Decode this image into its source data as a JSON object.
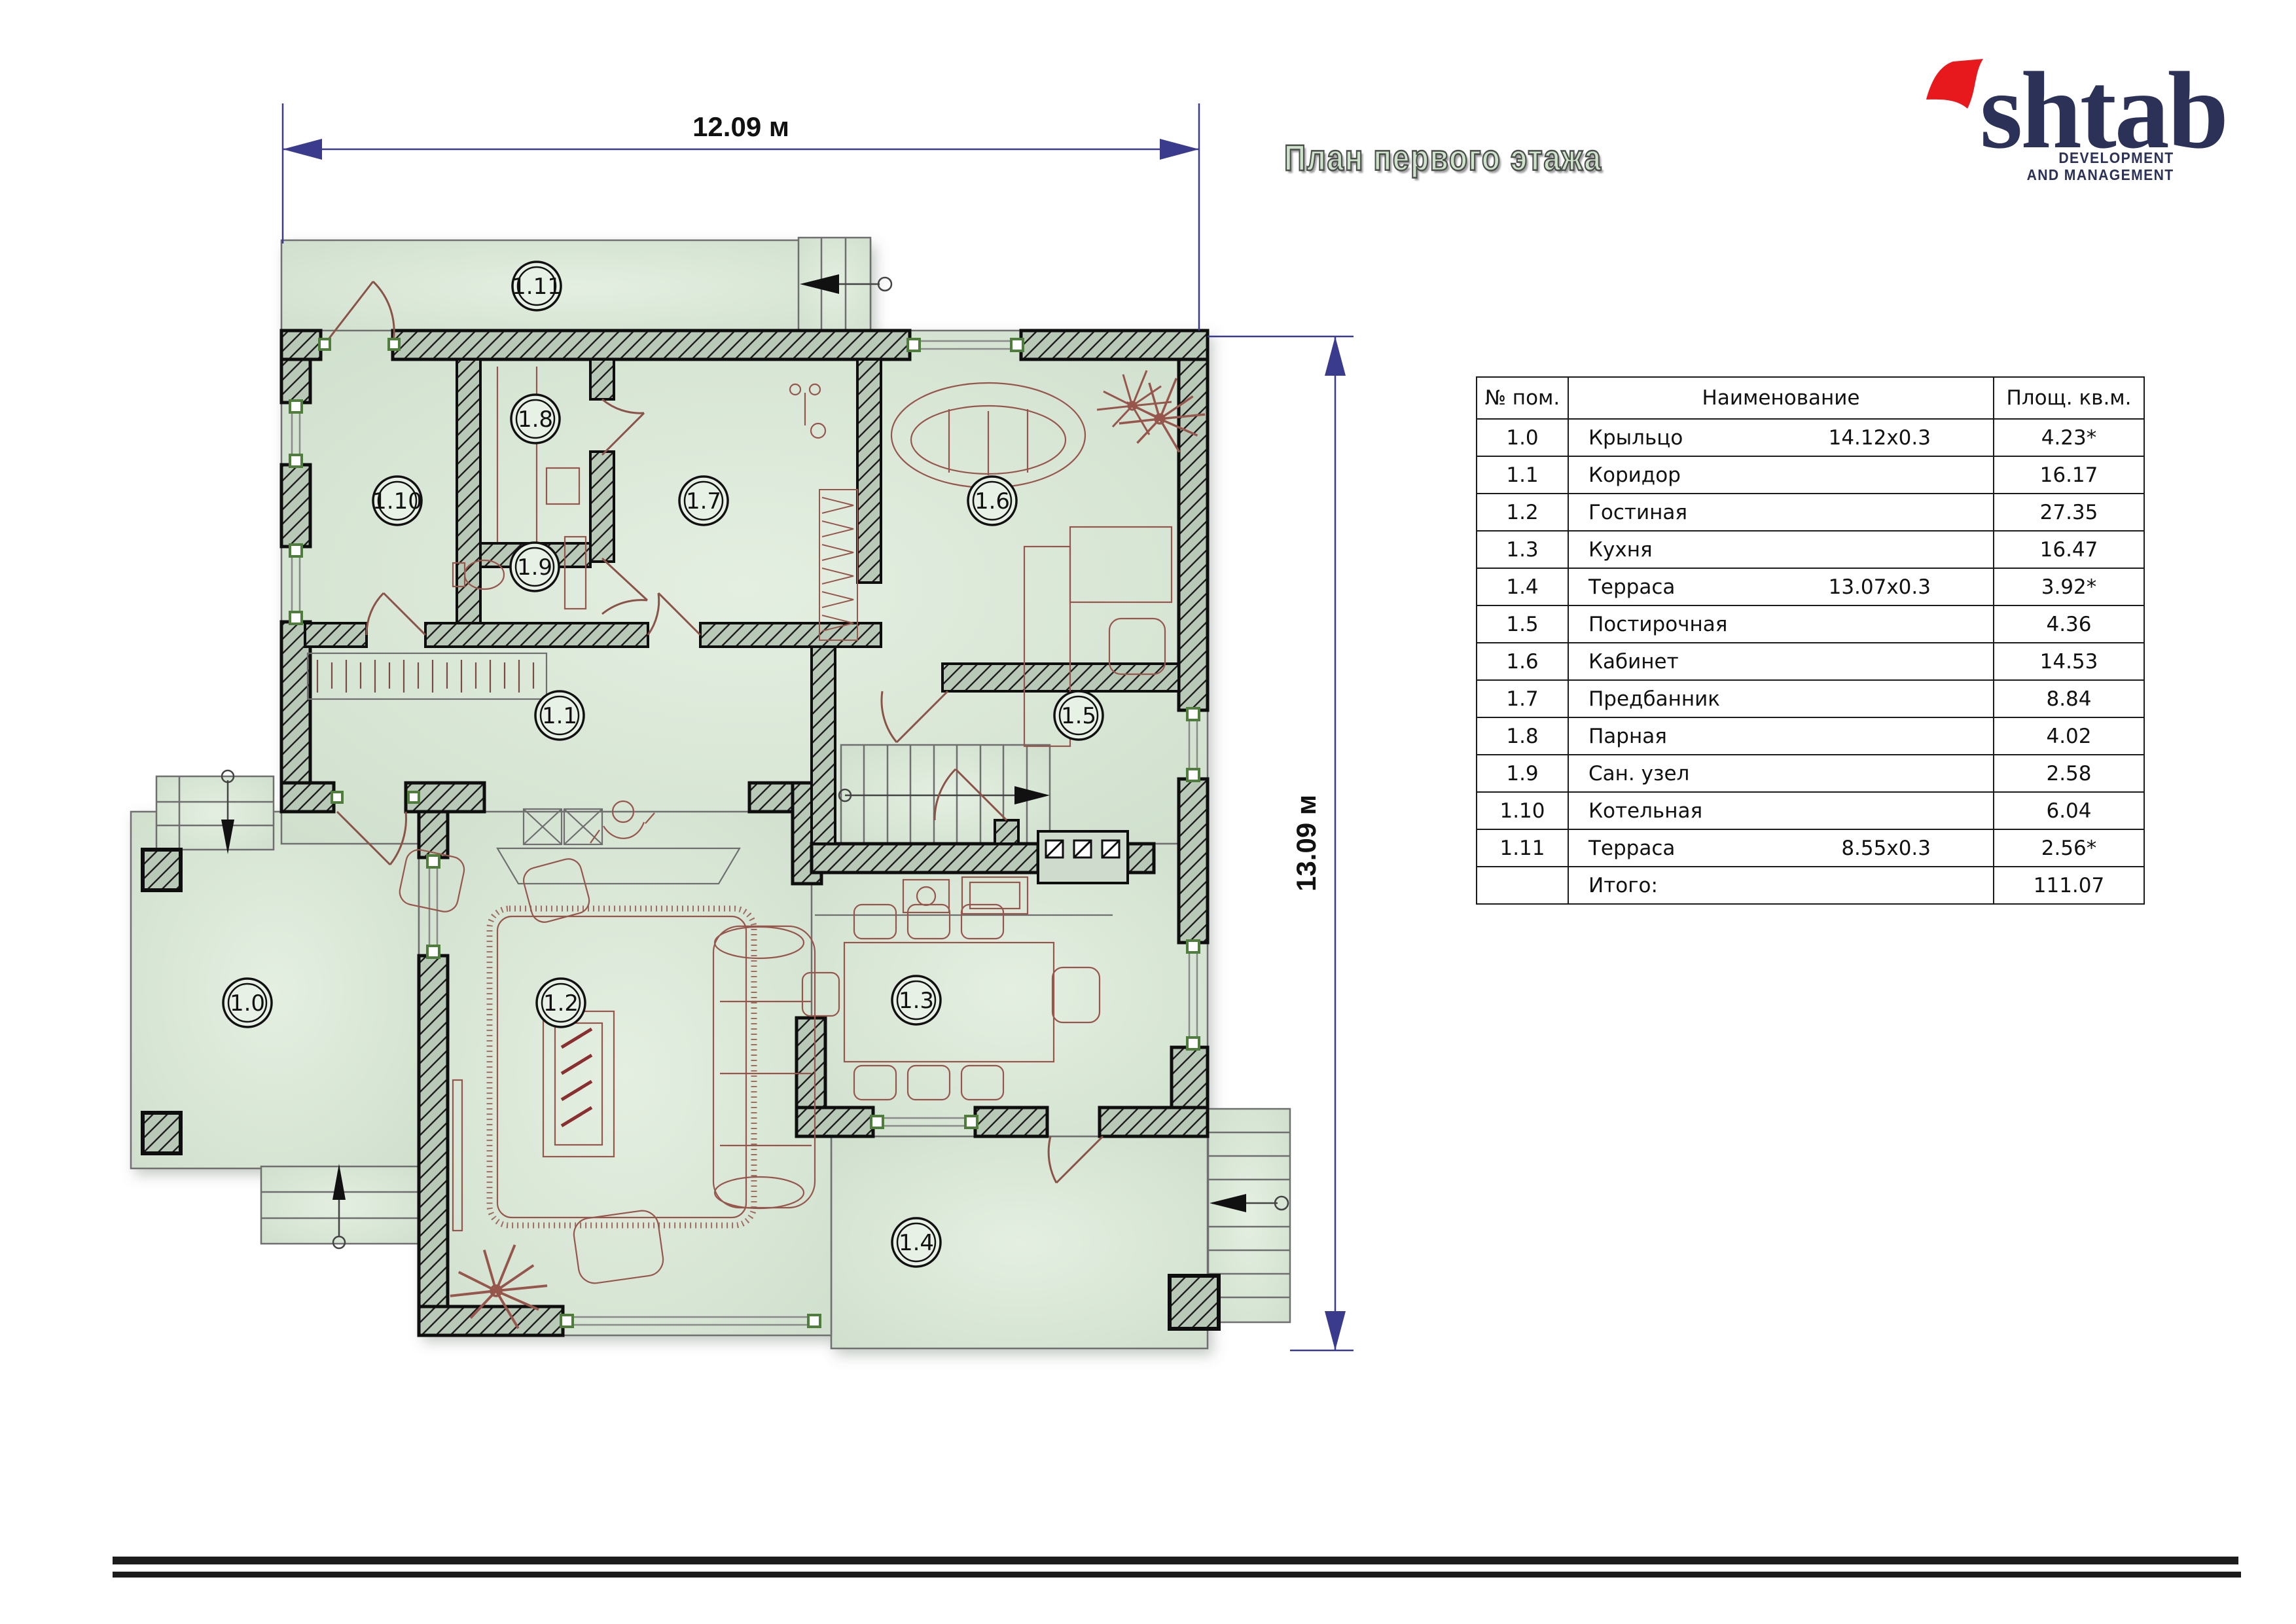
{
  "header": {
    "title": "План первого этажа"
  },
  "logo": {
    "name": "shtab",
    "tagline1": "DEVELOPMENT",
    "tagline2": "AND MANAGEMENT"
  },
  "plan": {
    "dim_width": "12.09 м",
    "dim_height": "13.09 м",
    "rooms": [
      {
        "label": "1.0"
      },
      {
        "label": "1.1"
      },
      {
        "label": "1.2"
      },
      {
        "label": "1.3"
      },
      {
        "label": "1.4"
      },
      {
        "label": "1.5"
      },
      {
        "label": "1.6"
      },
      {
        "label": "1.7"
      },
      {
        "label": "1.8"
      },
      {
        "label": "1.9"
      },
      {
        "label": "1.10"
      },
      {
        "label": "1.11"
      }
    ]
  },
  "table": {
    "headers": [
      "№  пом.",
      "Наименование",
      "Площ. кв.м."
    ],
    "rows": [
      {
        "num": "1.0",
        "name": "Крыльцо",
        "dims": "14.12x0.3",
        "area": "4.23*"
      },
      {
        "num": "1.1",
        "name": "Коридор",
        "dims": "",
        "area": "16.17"
      },
      {
        "num": "1.2",
        "name": "Гостиная",
        "dims": "",
        "area": "27.35"
      },
      {
        "num": "1.3",
        "name": "Кухня",
        "dims": "",
        "area": "16.47"
      },
      {
        "num": "1.4",
        "name": "Терраса",
        "dims": "13.07x0.3",
        "area": "3.92*"
      },
      {
        "num": "1.5",
        "name": "Постирочная",
        "dims": "",
        "area": "4.36"
      },
      {
        "num": "1.6",
        "name": "Кабинет",
        "dims": "",
        "area": "14.53"
      },
      {
        "num": "1.7",
        "name": "Предбанник",
        "dims": "",
        "area": "8.84"
      },
      {
        "num": "1.8",
        "name": "Парная",
        "dims": "",
        "area": "4.02"
      },
      {
        "num": "1.9",
        "name": "Сан. узел",
        "dims": "",
        "area": "2.58"
      },
      {
        "num": "1.10",
        "name": "Котельная",
        "dims": "",
        "area": "6.04"
      },
      {
        "num": "1.11",
        "name": "Терраса",
        "dims": "8.55x0.3",
        "area": "2.56*"
      },
      {
        "num": "",
        "name": "Итого:",
        "dims": "",
        "area": "111.07"
      }
    ]
  },
  "colors": {
    "floor_green": "#d7e5d4",
    "wall_hatch": "#b9c9b7",
    "dimension_navy": "#3b3b8e",
    "furniture_brown": "#96564c",
    "window_green": "#4f7d3c",
    "logo_navy": "#2c3157",
    "logo_red": "#e8191d",
    "title_fill": "#cfe3cc"
  }
}
